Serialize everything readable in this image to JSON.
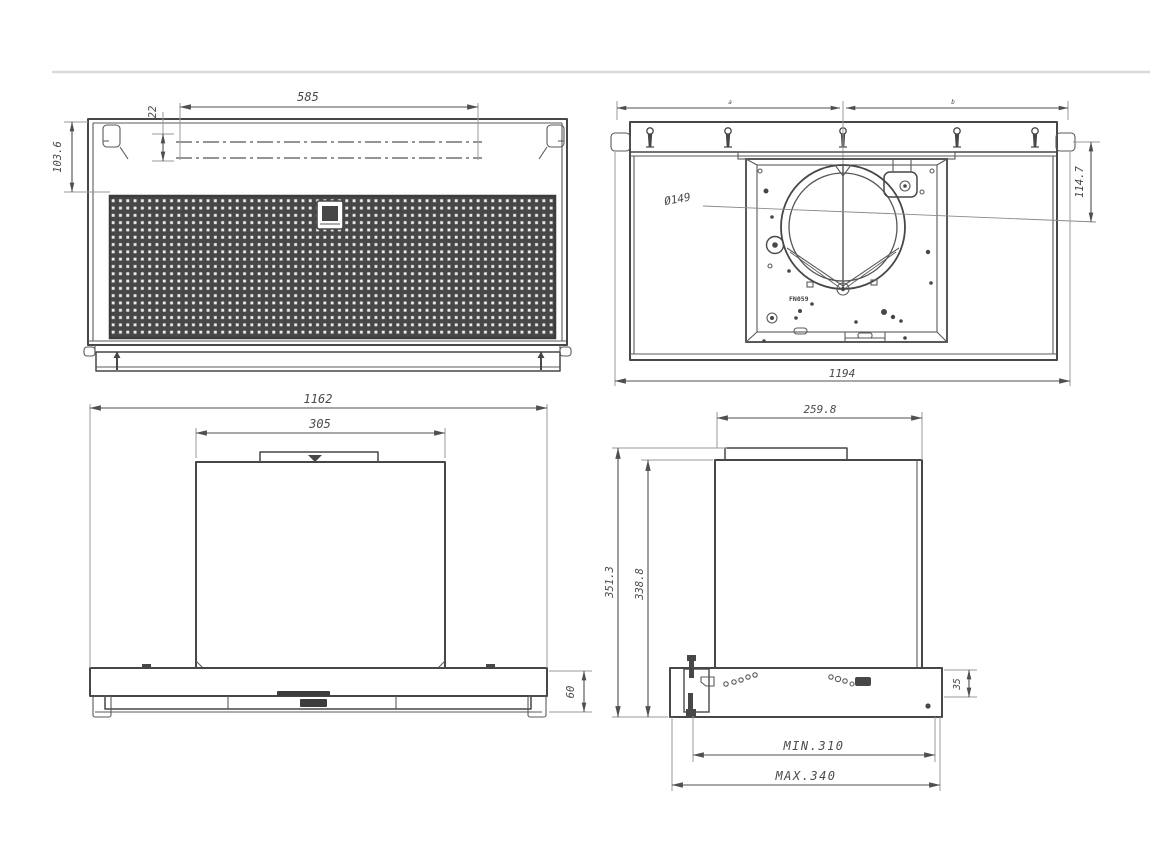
{
  "colors": {
    "line": "#474747",
    "dimension": "#4f4f4f",
    "divider": "#d9dadf",
    "mesh_dark": "#474747"
  },
  "views": {
    "bottom_view": {
      "dim_filter_width": "585",
      "dim_offset": "22",
      "dim_panel_height": "103.6"
    },
    "top_view": {
      "dim_span_left": "a",
      "dim_span_right": "b",
      "dim_duct_diameter": "Ø149",
      "dim_duct_inset": "114.7",
      "dim_overall_width": "1194",
      "part_code": "FN059"
    },
    "front_view": {
      "dim_overall_width": "1162",
      "dim_chimney_width": "305",
      "dim_body_height": "60"
    },
    "side_view": {
      "dim_top_depth": "259.8",
      "dim_overall_height": "351.3",
      "dim_body_height": "338.8",
      "dim_flange_height": "35",
      "dim_min_depth": "MIN.310",
      "dim_max_depth": "MAX.340"
    }
  }
}
